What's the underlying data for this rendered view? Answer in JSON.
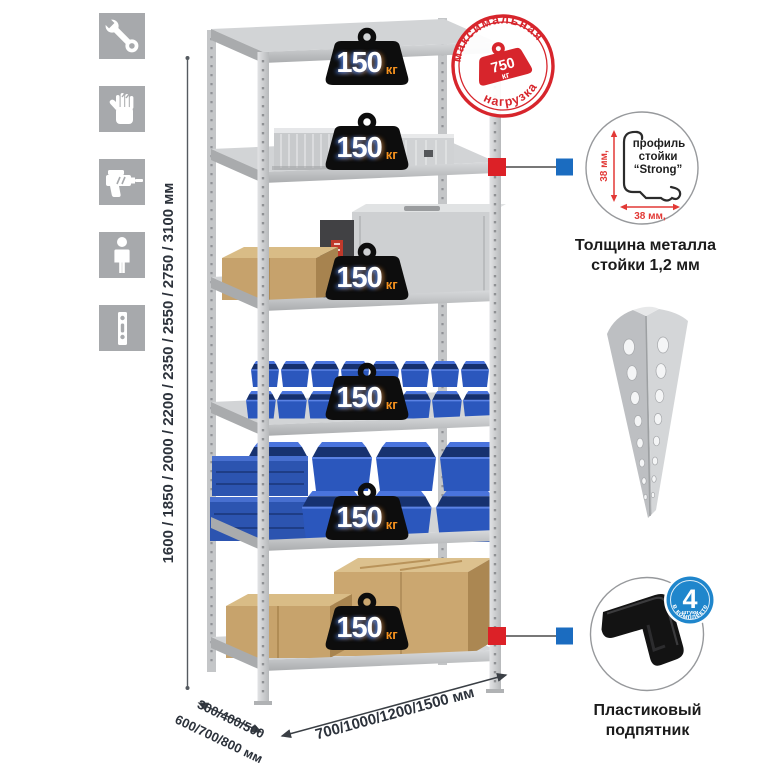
{
  "colors": {
    "stamp_red": "#d7252c",
    "marker_red": "#dc2127",
    "marker_blue": "#1b6cc0",
    "badge_blue": "#1f86cc",
    "badge_orange": "#f5921e",
    "bin_blue": "#2b57bd",
    "cardboard": "#c6a26c",
    "metal_gray": "#cfd1d3",
    "icon_gray": "#a7a9ac"
  },
  "left_icons": {
    "items": [
      {
        "icon": "wrench-icon"
      },
      {
        "icon": "gloves-icon"
      },
      {
        "icon": "drill-icon"
      },
      {
        "icon": "person-icon"
      },
      {
        "icon": "perforated-strip-icon"
      }
    ]
  },
  "height_dim": {
    "label": "1600 / 1850 / 2000 / 2200 / 2350 / 2550 / 2750 / 3100 мм"
  },
  "rack": {
    "badges": [
      {
        "value": "150",
        "unit": "кг"
      },
      {
        "value": "150",
        "unit": "кг"
      },
      {
        "value": "150",
        "unit": "кг"
      },
      {
        "value": "150",
        "unit": "кг"
      },
      {
        "value": "150",
        "unit": "кг"
      },
      {
        "value": "150",
        "unit": "кг"
      }
    ]
  },
  "stamp": {
    "arc_top": "максимальная",
    "arc_bottom": "нагрузка",
    "weight_value": "750",
    "weight_unit": "кг"
  },
  "profile_callout": {
    "text_line1": "профиль",
    "text_line2": "стойки",
    "text_line3": "“Strong”",
    "dim_vertical": "38 мм,",
    "dim_horizontal": "38 мм,",
    "caption1": "Толщина металла",
    "caption2": "стойки 1,2 мм"
  },
  "foot_callout": {
    "badge_number": "4",
    "badge_sub": "штуки",
    "badge_arc": "в комплекте",
    "caption1": "Пластиковый",
    "caption2": "подпятник"
  },
  "depth_dim": {
    "line1": "300/400/500",
    "line2": "600/700/800 мм"
  },
  "width_dim": {
    "label": "700/1000/1200/1500 мм"
  }
}
